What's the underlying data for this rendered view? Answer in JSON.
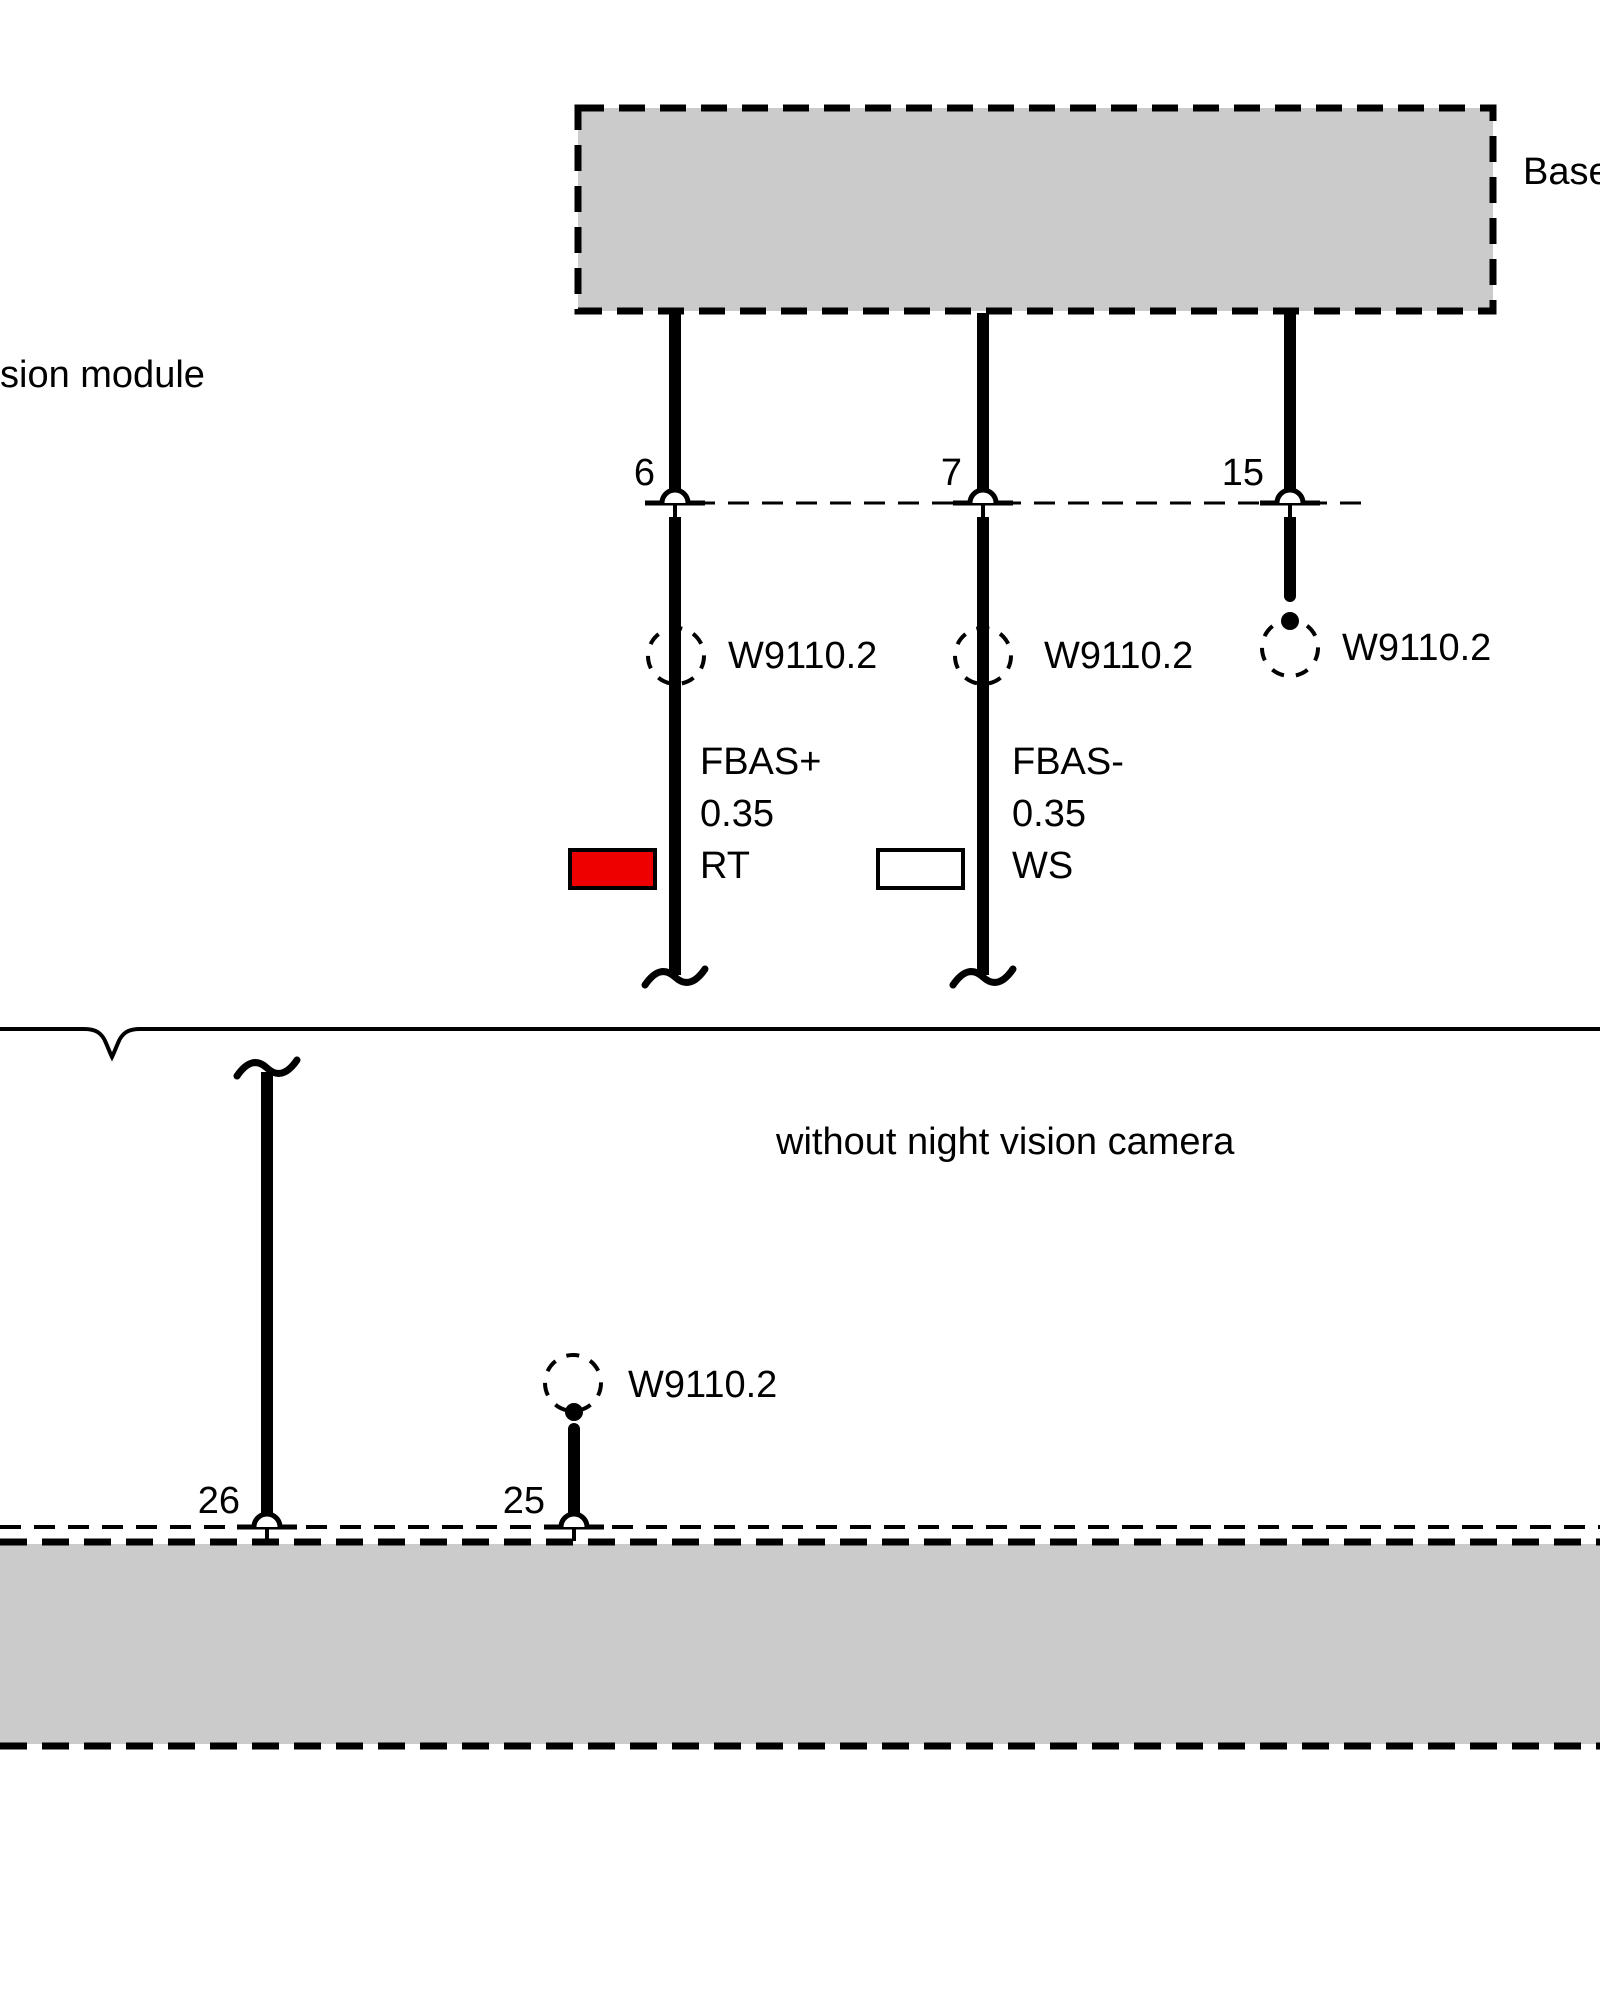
{
  "diagram": {
    "top_module_label": "Base",
    "left_module_label": "sion module",
    "variant_note": "without night vision camera",
    "splice_label": "W9110.2",
    "top_pins": [
      {
        "number": "6"
      },
      {
        "number": "7"
      },
      {
        "number": "15"
      }
    ],
    "bottom_pins": [
      {
        "number": "26"
      },
      {
        "number": "25"
      }
    ],
    "wires": [
      {
        "signal": "FBAS+",
        "cross_section": "0.35",
        "color_code": "RT",
        "color_hex": "#ee0000"
      },
      {
        "signal": "FBAS-",
        "cross_section": "0.35",
        "color_code": "WS",
        "color_hex": "#ffffff"
      }
    ],
    "colors": {
      "module_fill": "#cbcbcb",
      "line": "#000000",
      "background": "#ffffff"
    }
  }
}
